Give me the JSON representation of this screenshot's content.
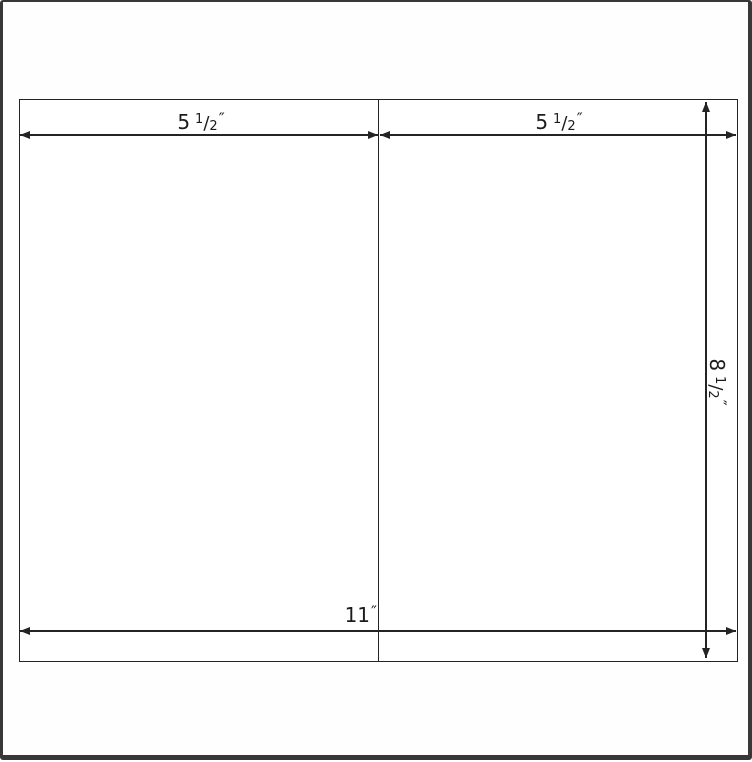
{
  "canvas": {
    "width": 752,
    "height": 760
  },
  "colors": {
    "frame": "#383838",
    "line": "#242424",
    "text": "#1c1c1c",
    "paper": "#ffffff"
  },
  "diagram": {
    "description": "half-fold card sheet template with dimension arrows",
    "labels": {
      "left_panel_width": {
        "whole": "5",
        "numerator": "1",
        "denominator": "2",
        "unit": "″"
      },
      "right_panel_width": {
        "whole": "5",
        "numerator": "1",
        "denominator": "2",
        "unit": "″"
      },
      "total_width": {
        "whole": "11",
        "unit": "″"
      },
      "sheet_height": {
        "whole": "8",
        "numerator": "1",
        "denominator": "2",
        "unit": "″"
      }
    }
  }
}
